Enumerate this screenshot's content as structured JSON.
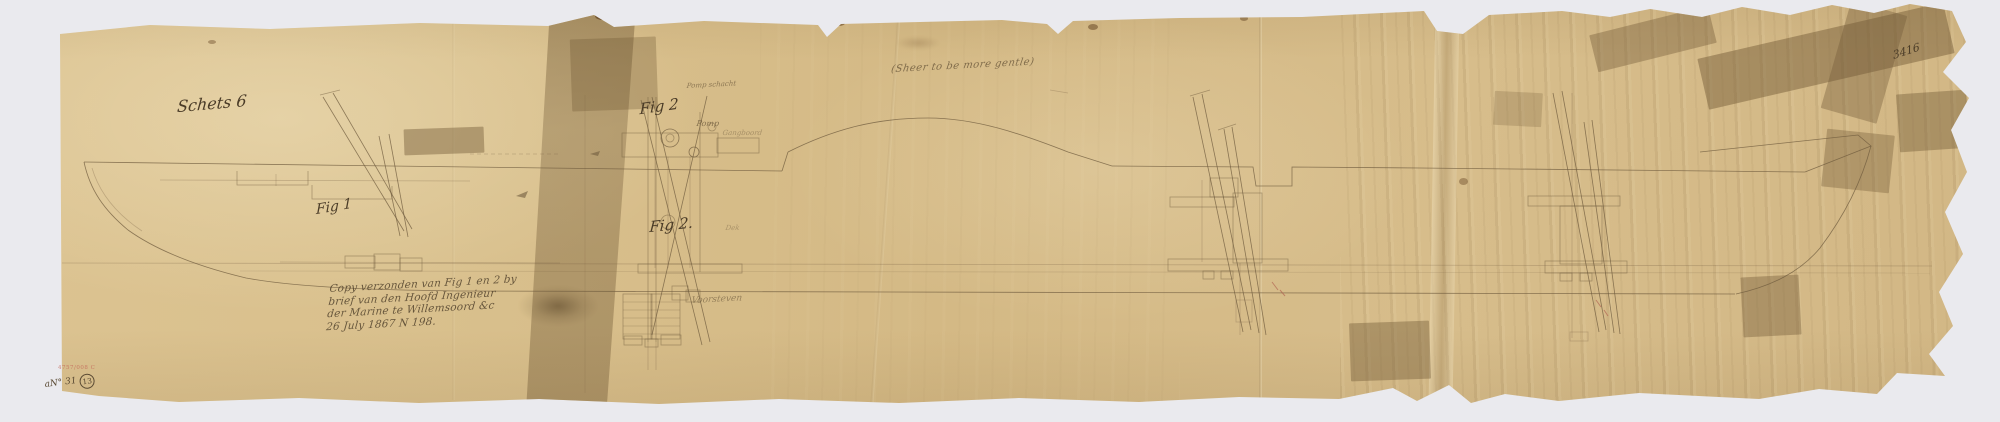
{
  "scan": {
    "background_color": "#eaeaee",
    "paper_color": "#d6bc8a",
    "tape_color": "#8a7046",
    "line_ink_color": "#6f5b3e",
    "handwriting_ink_color": "#4a3b27",
    "red_mark_color": "#c4685a"
  },
  "titles": {
    "sheet_label": "Schets 6",
    "drawing_number": "3416"
  },
  "annotations": {
    "center_note": "(Sheer to be more gentle)",
    "fig1": "Fig 1",
    "fig2_upper": "Fig 2",
    "fig2_lower": "Fig 2.",
    "pomp_schacht": "Pomp schacht",
    "pomp": "Pomp",
    "gangboord": "Gangboord",
    "dek": "Dek",
    "bottom_caption": "Voorsteven"
  },
  "note": {
    "lines": [
      "Copy verzonden van Fig 1 en 2 by",
      "brief van den Hoofd Ingenieur",
      "der Marine te Willemsoord &c",
      "26 July 1867 N 198."
    ]
  },
  "marks": {
    "accession_number": "4757/008 C",
    "inventory_mark": "aN° 31",
    "inventory_circle": "13"
  }
}
